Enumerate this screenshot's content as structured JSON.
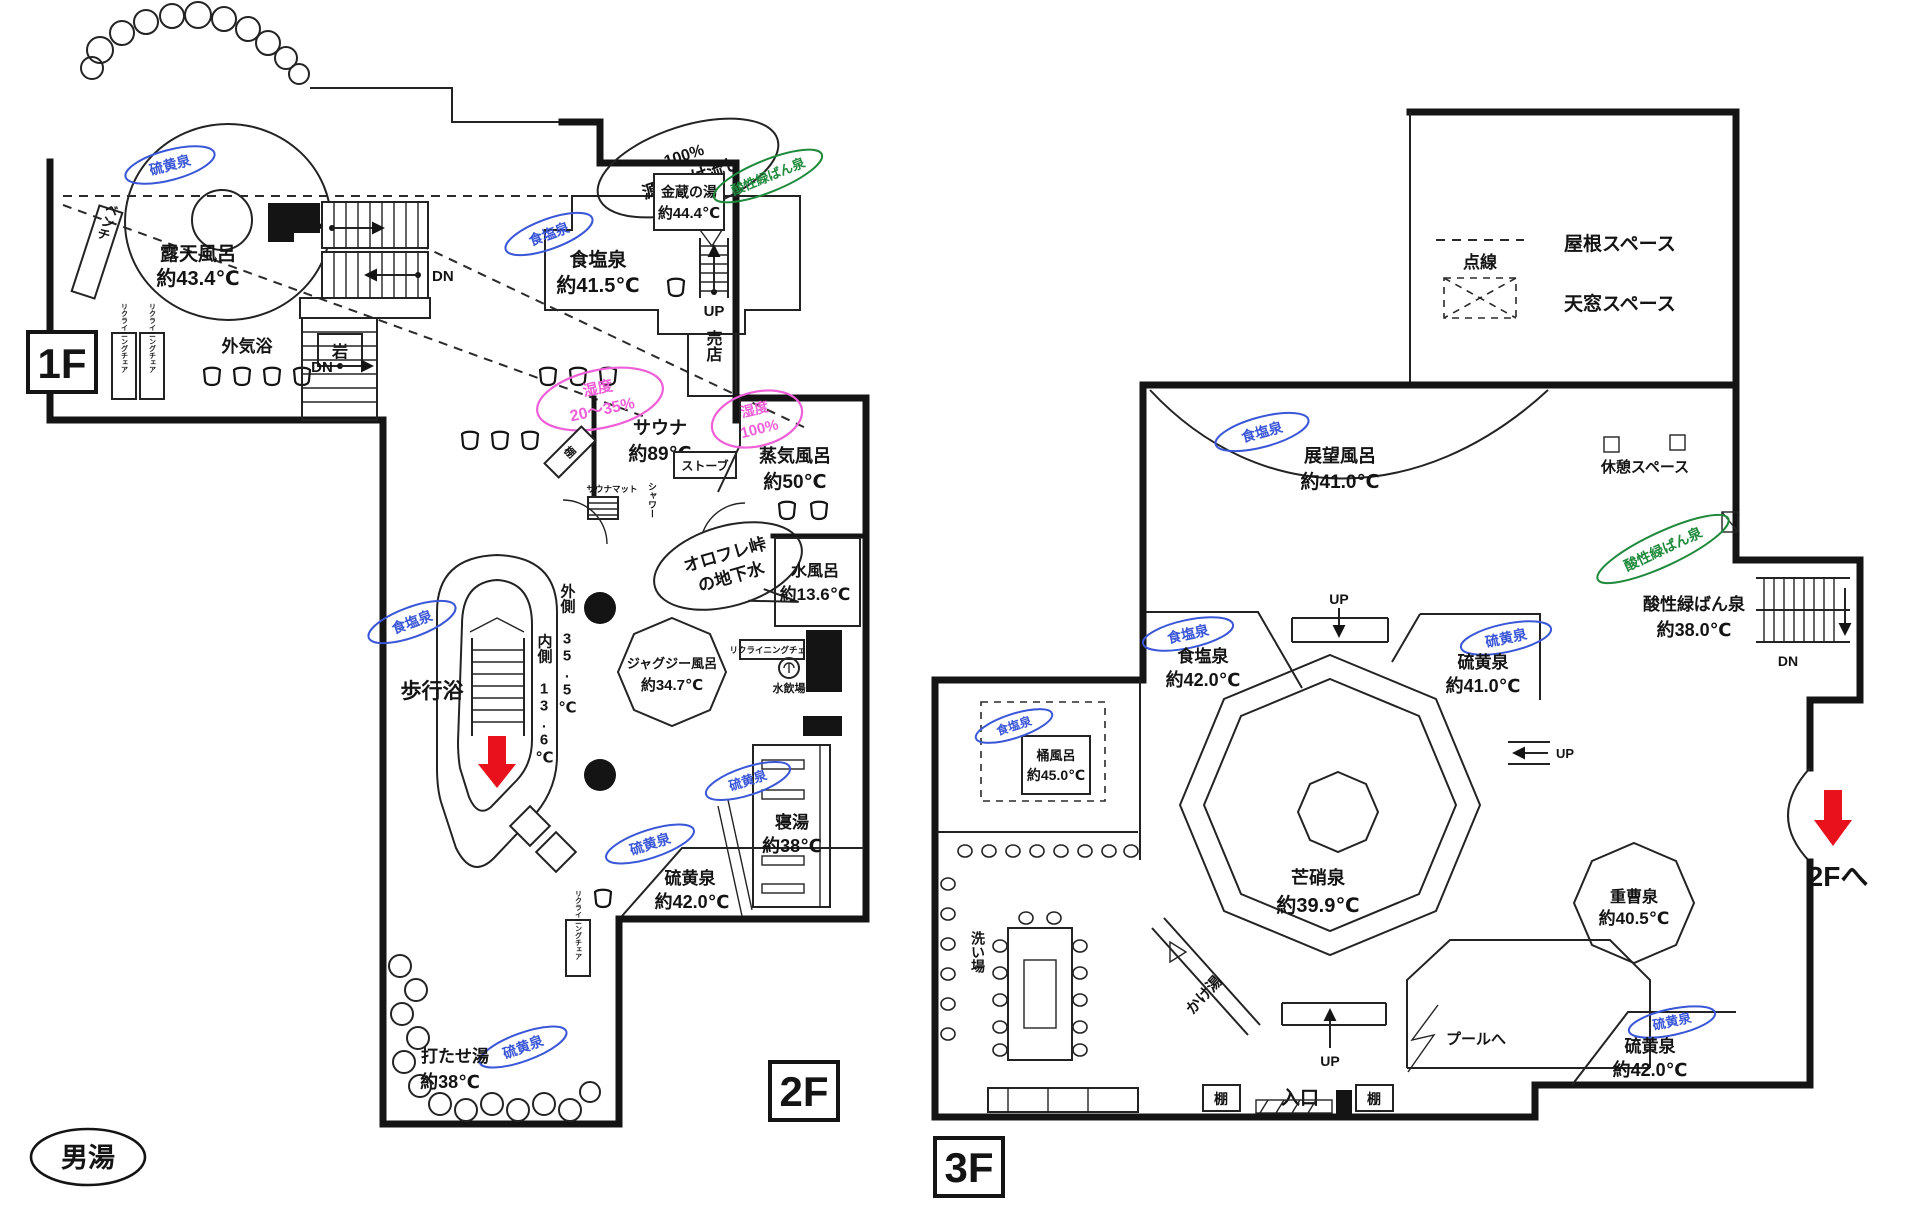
{
  "stamp": "男湯",
  "floor_labels": {
    "f1": "1F",
    "f2": "2F",
    "f3": "3F",
    "to_2f": "2Fへ"
  },
  "nav": {
    "up": "UP",
    "dn": "DN"
  },
  "legend": {
    "dotted": "点線",
    "roof": "屋根スペース",
    "skylight": "天窓スペース"
  },
  "spring_tags": {
    "sulfur": "硫黄泉",
    "salt": "食塩泉",
    "acid_green": "酸性緑ばん泉"
  },
  "f1": {
    "rotenburo_name": "露天風呂",
    "rotenburo_temp": "約43.4℃",
    "bench": "ベンチ",
    "gaikiyoku": "外気浴",
    "iwa": "岩",
    "recliner": "リクライニングチェア",
    "shokusen_name": "食塩泉",
    "shokusen_temp": "約41.5℃",
    "gensen_line1": "100%",
    "gensen_line2": "源泉かけ流し",
    "kinzo_name": "金蔵の湯",
    "kinzo_temp": "約44.4℃",
    "baiten": "売店"
  },
  "f2": {
    "sauna_name": "サウナ",
    "sauna_temp": "約89℃",
    "sauna_hum1": "湿度",
    "sauna_hum2": "20〜35%",
    "stove": "ストーブ",
    "tana": "棚",
    "sauna_mat": "サウナマット",
    "shower": "シャワー",
    "joki_name": "蒸気風呂",
    "joki_temp": "約50℃",
    "joki_hum1": "湿度",
    "joki_hum2": "100%",
    "orofure1": "オロフレ峠",
    "orofure2": "の地下水",
    "mizuburo_name": "水風呂",
    "mizuburo_temp": "約13.6℃",
    "recliner": "リクライニングチェア",
    "mizunomiba": "水飲場",
    "jacuzzi_name": "ジャグジー風呂",
    "jacuzzi_temp": "約34.7℃",
    "hokoyoku": "歩行浴",
    "outer_lane": "外側 35.5℃",
    "inner_lane": "内側 13.6℃",
    "iou_name": "硫黄泉",
    "iou_temp": "約42.0℃",
    "neyu_name": "寝湯",
    "neyu_temp": "約38℃",
    "utase_name": "打たせ湯",
    "utase_temp": "約38℃"
  },
  "f3": {
    "tenbo_name": "展望風呂",
    "tenbo_temp": "約41.0℃",
    "kyukei": "休憩スペース",
    "sansei_name": "酸性緑ばん泉",
    "sansei_temp": "約38.0℃",
    "shokusen_name": "食塩泉",
    "shokusen_temp": "約42.0℃",
    "iou41_name": "硫黄泉",
    "iou41_temp": "約41.0℃",
    "oke_name": "桶風呂",
    "oke_temp": "約45.0℃",
    "bosho_name": "芒硝泉",
    "bosho_temp": "約39.9℃",
    "juso_name": "重曹泉",
    "juso_temp": "約40.5℃",
    "iou42_name": "硫黄泉",
    "iou42_temp": "約42.0℃",
    "araiba": "洗い場",
    "kakeyu": "かけ湯",
    "pool": "プールへ",
    "iriguchi": "入口",
    "tana": "棚"
  },
  "colors": {
    "spring_blue": "#3a57d8",
    "acid_green": "#1f8a3c",
    "humidity_pink": "#ef5fd7",
    "arrow_red": "#e8111c",
    "ink": "#141414"
  }
}
